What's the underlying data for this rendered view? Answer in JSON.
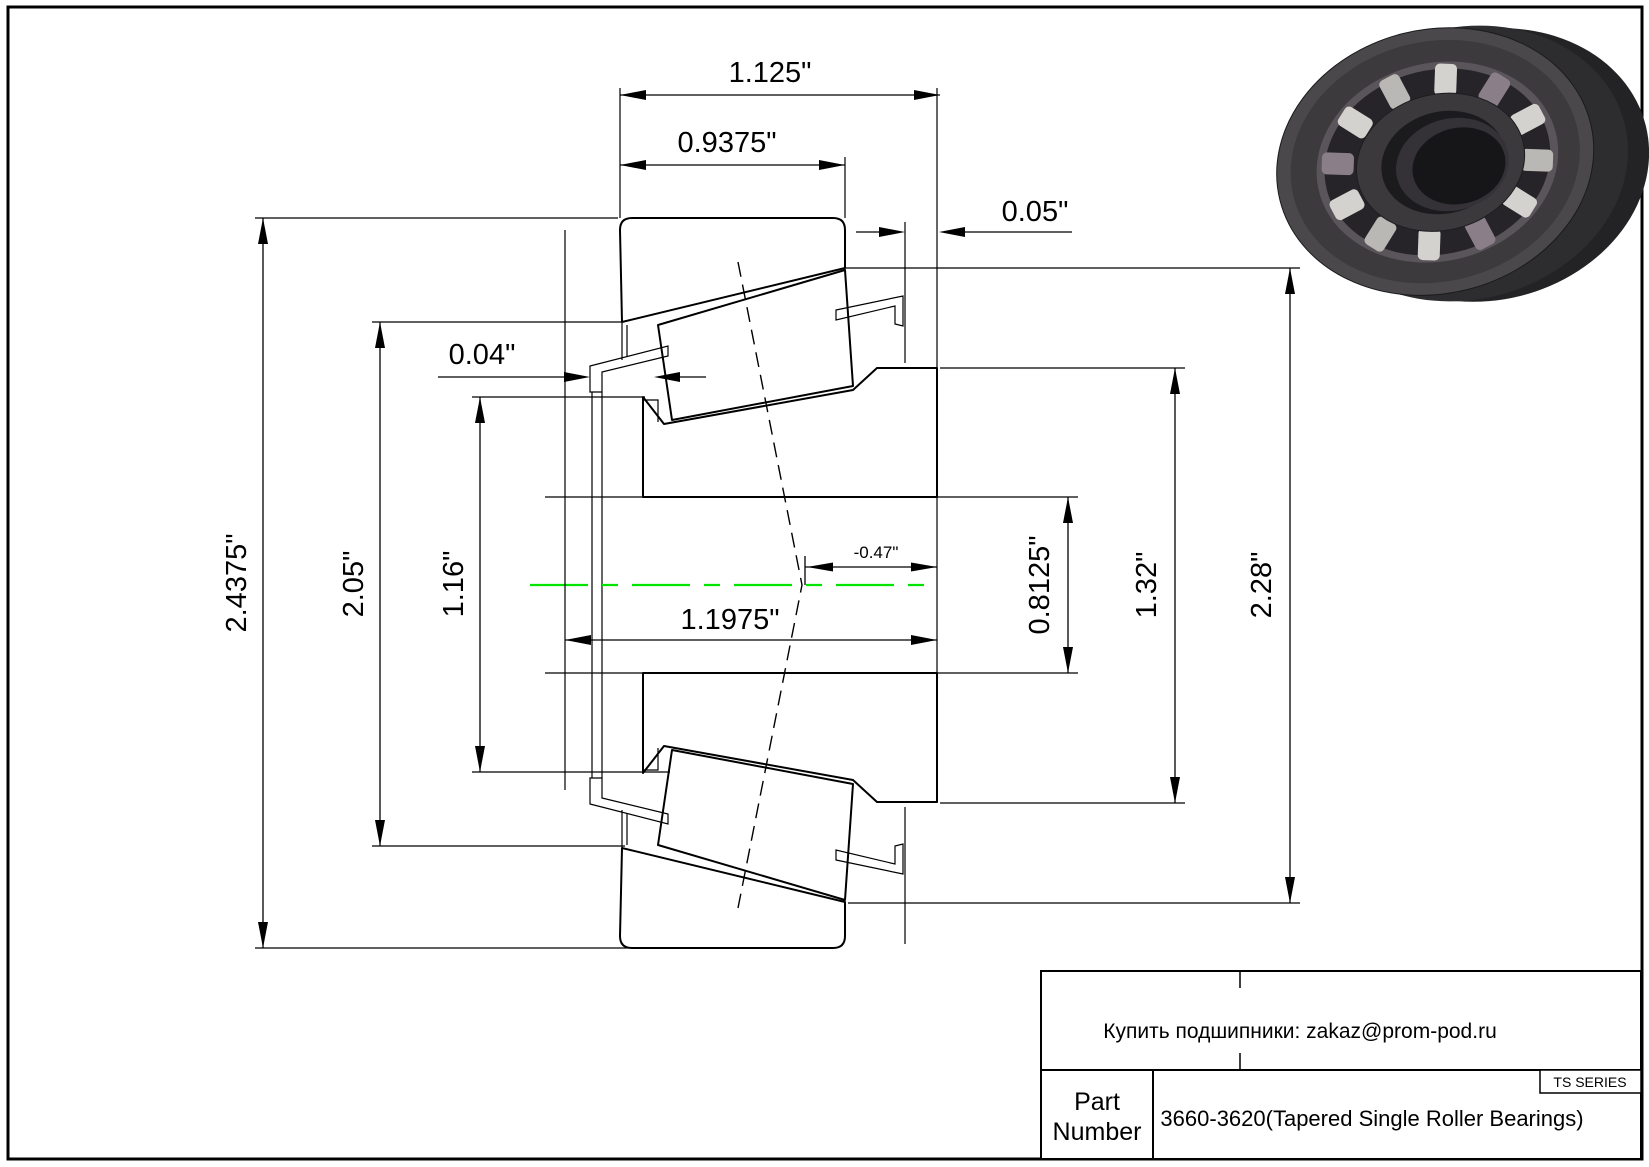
{
  "drawing": {
    "dims": {
      "overall_width": "1.125\"",
      "cup_width": "0.9375\"",
      "cone_standout": "0.05\"",
      "cage_clearance": "0.04\"",
      "flange_od": "2.4375\"",
      "cup_front_od": "2.05\"",
      "cone_rib_od": "1.16\"",
      "cage_width": "1.1975\"",
      "effective_center": "-0.47\"",
      "bore": "0.8125\"",
      "cone_od": "1.32\"",
      "cup_od": "2.28\""
    },
    "centerline_color": "#00e400",
    "line_color": "#000000"
  },
  "title_block": {
    "contact": "Купить подшипники: zakaz@prom-pod.ru",
    "series_label": "TS SERIES",
    "part_label_line1": "Part",
    "part_label_line2": "Number",
    "part_value": "3660-3620(Tapered Single Roller Bearings)"
  }
}
